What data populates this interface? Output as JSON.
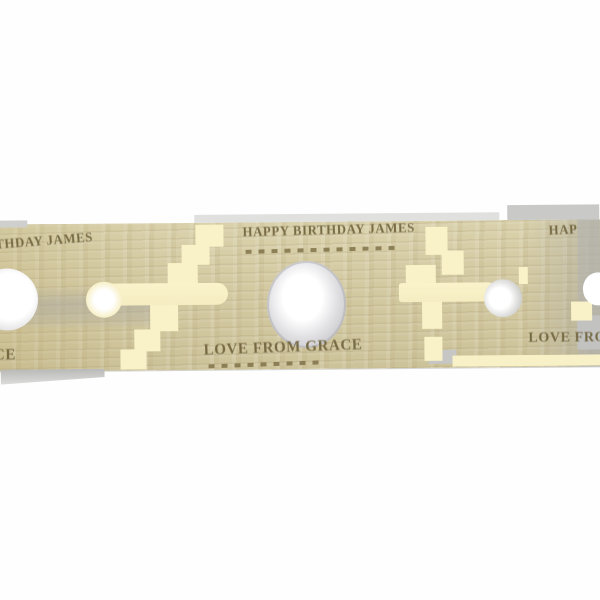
{
  "photo": {
    "engraving": {
      "top_line": "HAPPY BIRTHDAY JAMES",
      "bottom_line": "LOVE FROM GRACE"
    },
    "partial_engraving": {
      "left_top": "RTHDAY JAMES",
      "left_bottom": "ACE",
      "right_top": "HAPPY BI",
      "right_bottom": "LOVE FROM GR"
    },
    "colors": {
      "background": "#fefefe",
      "wood_light": "#d9d1ab",
      "wood_mid": "#cfc59d",
      "wood_gray": "#c7c6c2",
      "artifact_cream": "#f9f2c8",
      "engraving_brown": "#6b5e36",
      "hole_gray": "#c9c9cd"
    }
  }
}
